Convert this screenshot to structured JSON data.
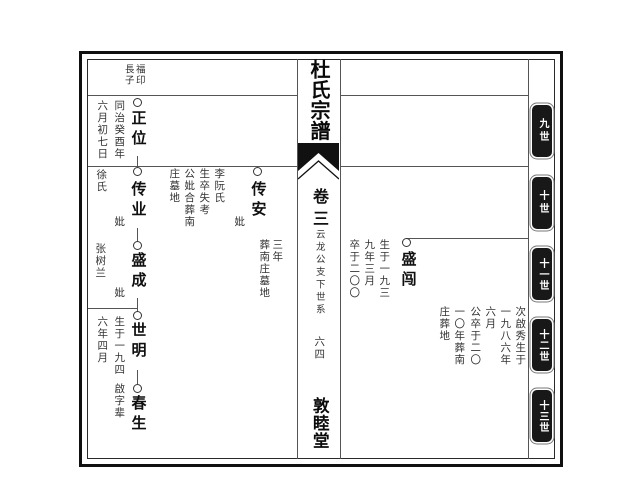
{
  "colors": {
    "ink": "#222222",
    "rule": "#555555",
    "tab_bg": "#181818",
    "tab_text": "#ffffff"
  },
  "spine": {
    "title": "杜氏宗譜",
    "volume": "卷三",
    "series_note": "云龙公支下世系",
    "page_number": "六四",
    "hall": "敦睦堂"
  },
  "header": {
    "father_name": "福印",
    "relation": "長子"
  },
  "generation_tabs": [
    {
      "label": "九世"
    },
    {
      "label": "十世"
    },
    {
      "label": "十一世"
    },
    {
      "label": "十二世"
    },
    {
      "label": "十三世"
    }
  ],
  "left_lineage": {
    "zhengwei": {
      "name": "正位",
      "date_line_1": "同治癸酉年",
      "date_line_2": "六月初七日"
    },
    "chuanye": {
      "name": "传业",
      "wife_label": "妣",
      "wife_surname": "徐氏"
    },
    "chuanan": {
      "name": "传安",
      "wife_label": "妣",
      "record_line_1": "李阮氏",
      "record_line_2": "生卒失考",
      "record_line_3": "公妣合葬南",
      "record_line_4": "庄墓地"
    },
    "shengcheng": {
      "name": "盛成",
      "wife_label": "妣",
      "wife_name": "张树兰"
    },
    "shiming": {
      "name": "世明",
      "birth_line_1": "生于一九四",
      "birth_line_2": "六年四月"
    },
    "chunsheng": {
      "name": "春生",
      "generation_note": "啟字辈"
    },
    "burial_note_line_1": "三年",
    "burial_note_line_2": "葬南庄墓地"
  },
  "right_lineage": {
    "shengchuang": {
      "name": "盛闯",
      "record_line_1": "生于一九三",
      "record_line_2": "九年三月",
      "record_line_3": "卒于二〇〇"
    },
    "note_cols": [
      "次啟秀生于",
      "一九八六年",
      "六月",
      "公卒于二〇",
      "一〇年葬南",
      "庄葬地"
    ]
  }
}
